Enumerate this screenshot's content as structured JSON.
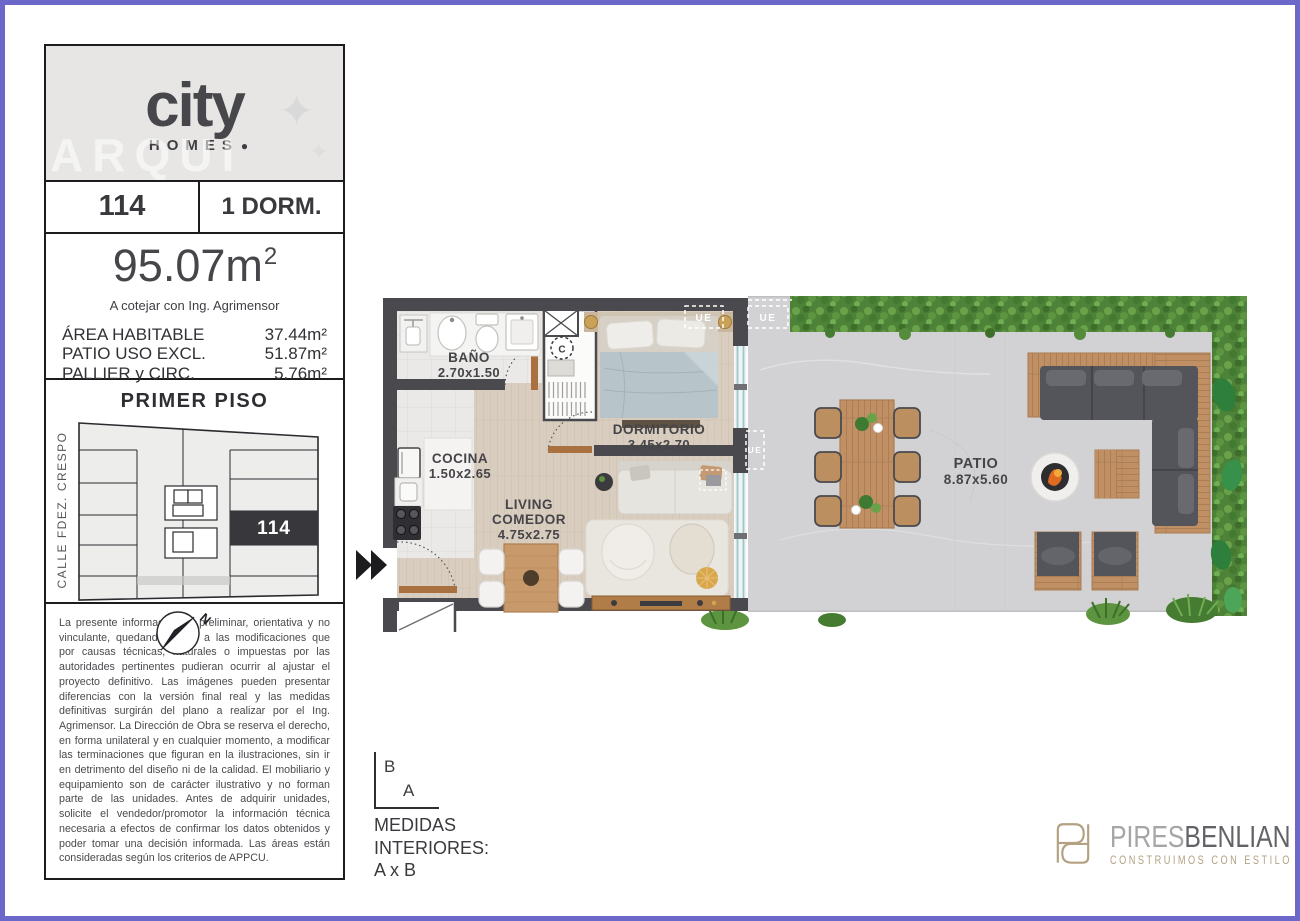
{
  "sidebar": {
    "logo": {
      "brand": "city",
      "sub": "HOMES",
      "dot": "●",
      "star": "✦",
      "watermark": "ARQUI"
    },
    "unit": {
      "number": "114",
      "type": "1 DORM."
    },
    "area": {
      "total": "95.07m",
      "sup": "2",
      "note": "A cotejar con Ing. Agrimensor",
      "rows": [
        {
          "label": "ÁREA HABITABLE",
          "value": "37.44m²"
        },
        {
          "label": "PATIO USO EXCL.",
          "value": "51.87m²"
        },
        {
          "label": "PALLIER y CIRC.",
          "value": "5.76m²"
        }
      ]
    },
    "keyplan": {
      "title": "PRIMER PISO",
      "street": "CALLE FDEZ. CRESPO",
      "highlight_unit": "114",
      "north": "N"
    },
    "disclaimer": "La presente información es preliminar, orientativa y no vinculante, quedando sujeta a las modificaciones que por causas técnicas, naturales o impuestas por las autoridades pertinentes pudieran ocurrir al ajustar el proyecto definitivo. Las imágenes pueden presentar diferencias con la versión final real y las medidas definitivas surgirán del plano a realizar por el Ing. Agrimensor. La Dirección de Obra se reserva el derecho, en forma unilateral y en cualquier momento, a modificar las terminaciones que figuran en la ilustraciones, sin ir en detrimento del diseño ni de la calidad. El mobiliario y equipamiento son de carácter ilustrativo y no forman parte de las unidades. Antes de adquirir unidades, solicite el vendedor/promotor la información técnica necesaria a efectos de confirmar los datos obtenidos y poder tomar una decisión informada. Las áreas están consideradas según los criterios de APPCU."
  },
  "plan": {
    "rooms": {
      "bano": {
        "name": "BAÑO",
        "dims": "2.70x1.50"
      },
      "dormitorio": {
        "name": "DORMITORIO",
        "dims": "3.45x2.70"
      },
      "cocina": {
        "name": "COCINA",
        "dims": "1.50x2.65"
      },
      "living": {
        "name": "LIVING",
        "name2": "COMEDOR",
        "dims": "4.75x2.75"
      },
      "patio": {
        "name": "PATIO",
        "dims": "8.87x5.60"
      }
    },
    "markers": {
      "closet": "C",
      "ue": "UE"
    }
  },
  "legend": {
    "b": "B",
    "a": "A",
    "line1": "MEDIDAS",
    "line2": "INTERIORES:",
    "line3": "A x B"
  },
  "developer": {
    "name1": "PIRES",
    "name2": "BENLIAN",
    "tagline": "CONSTRUIMOS CON ESTILO"
  },
  "colors": {
    "accent_border": "#6b68c9",
    "wall": "#4a4a4e",
    "keyplan_highlight": "#38383c",
    "brand_gold": "#b3a182"
  }
}
